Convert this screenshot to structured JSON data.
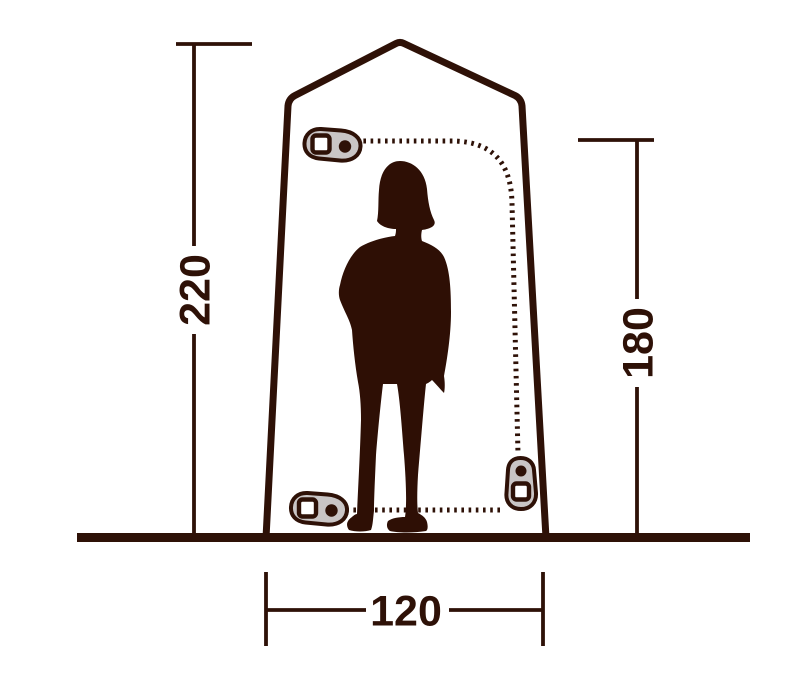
{
  "figure": {
    "dimension_labels": {
      "left_height": "220",
      "right_height": "180",
      "bottom_width": "120"
    },
    "icons": {
      "zipper_pull_top_left": "zipper-pull-icon",
      "zipper_pull_bottom_left": "zipper-pull-icon",
      "zipper_pull_bottom_right": "zipper-pull-icon"
    }
  },
  "colors": {
    "line": "#2e1107",
    "silhouette": "#2e0f05",
    "zipper_fill": "#c9c5c5",
    "background": "#ffffff"
  }
}
